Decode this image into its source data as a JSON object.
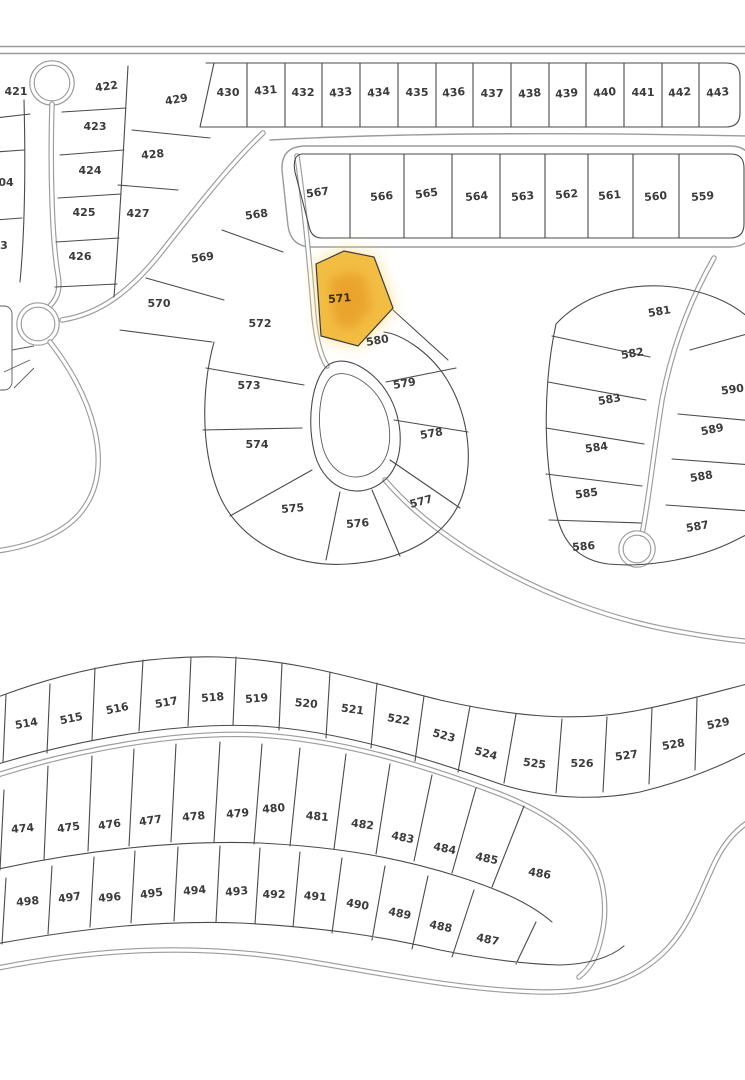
{
  "map": {
    "type": "subdivision-plat-map",
    "highlight": {
      "lot": "571",
      "fill": "#F2BD43",
      "glow": "#F8DC82",
      "core": "#E9A02C"
    },
    "colors": {
      "background": "#ffffff",
      "parcel_line": "#4a4a4a",
      "road_line": "#9b9b9b",
      "label": "#3b3b3b"
    },
    "lots": [
      {
        "n": "421",
        "x": 16,
        "y": 95,
        "r": 0
      },
      {
        "n": "422",
        "x": 107,
        "y": 90,
        "r": -8
      },
      {
        "n": "423",
        "x": 95,
        "y": 130,
        "r": 0
      },
      {
        "n": "424",
        "x": 90,
        "y": 174,
        "r": 0
      },
      {
        "n": "425",
        "x": 84,
        "y": 216,
        "r": 0
      },
      {
        "n": "426",
        "x": 80,
        "y": 260,
        "r": 0
      },
      {
        "n": "427",
        "x": 138,
        "y": 217,
        "r": 0
      },
      {
        "n": "428",
        "x": 153,
        "y": 158,
        "r": -5
      },
      {
        "n": "429",
        "x": 177,
        "y": 103,
        "r": -10
      },
      {
        "n": "04",
        "x": 6,
        "y": 186,
        "r": 0
      },
      {
        "n": "3",
        "x": 4,
        "y": 249,
        "r": 0
      },
      {
        "n": "430",
        "x": 228,
        "y": 96,
        "r": 0
      },
      {
        "n": "431",
        "x": 266,
        "y": 94,
        "r": -5
      },
      {
        "n": "432",
        "x": 303,
        "y": 96,
        "r": 0
      },
      {
        "n": "433",
        "x": 341,
        "y": 96,
        "r": -5
      },
      {
        "n": "434",
        "x": 379,
        "y": 96,
        "r": -5
      },
      {
        "n": "435",
        "x": 417,
        "y": 96,
        "r": 0
      },
      {
        "n": "436",
        "x": 454,
        "y": 96,
        "r": -5
      },
      {
        "n": "437",
        "x": 492,
        "y": 97,
        "r": 0
      },
      {
        "n": "438",
        "x": 530,
        "y": 97,
        "r": -5
      },
      {
        "n": "439",
        "x": 567,
        "y": 97,
        "r": -5
      },
      {
        "n": "440",
        "x": 605,
        "y": 96,
        "r": -5
      },
      {
        "n": "441",
        "x": 643,
        "y": 96,
        "r": 0
      },
      {
        "n": "442",
        "x": 680,
        "y": 96,
        "r": -5
      },
      {
        "n": "443",
        "x": 718,
        "y": 96,
        "r": -5
      },
      {
        "n": "567",
        "x": 318,
        "y": 196,
        "r": -8
      },
      {
        "n": "566",
        "x": 382,
        "y": 200,
        "r": -5
      },
      {
        "n": "565",
        "x": 427,
        "y": 197,
        "r": -8
      },
      {
        "n": "564",
        "x": 477,
        "y": 200,
        "r": -5
      },
      {
        "n": "563",
        "x": 523,
        "y": 200,
        "r": -5
      },
      {
        "n": "562",
        "x": 567,
        "y": 198,
        "r": -5
      },
      {
        "n": "561",
        "x": 610,
        "y": 199,
        "r": -5
      },
      {
        "n": "560",
        "x": 656,
        "y": 200,
        "r": -5
      },
      {
        "n": "559",
        "x": 703,
        "y": 200,
        "r": -5
      },
      {
        "n": "568",
        "x": 257,
        "y": 218,
        "r": -8
      },
      {
        "n": "569",
        "x": 203,
        "y": 261,
        "r": -8
      },
      {
        "n": "570",
        "x": 159,
        "y": 307,
        "r": 0
      },
      {
        "n": "571",
        "x": 340,
        "y": 302,
        "r": -5
      },
      {
        "n": "572",
        "x": 260,
        "y": 327,
        "r": 0
      },
      {
        "n": "573",
        "x": 249,
        "y": 389,
        "r": 0
      },
      {
        "n": "574",
        "x": 257,
        "y": 448,
        "r": 0
      },
      {
        "n": "575",
        "x": 293,
        "y": 512,
        "r": -5
      },
      {
        "n": "576",
        "x": 358,
        "y": 527,
        "r": -5
      },
      {
        "n": "577",
        "x": 422,
        "y": 505,
        "r": -15
      },
      {
        "n": "578",
        "x": 432,
        "y": 437,
        "r": -10
      },
      {
        "n": "579",
        "x": 405,
        "y": 387,
        "r": -10
      },
      {
        "n": "580",
        "x": 378,
        "y": 344,
        "r": -10
      },
      {
        "n": "581",
        "x": 660,
        "y": 315,
        "r": -10
      },
      {
        "n": "582",
        "x": 633,
        "y": 357,
        "r": -10
      },
      {
        "n": "583",
        "x": 610,
        "y": 403,
        "r": -10
      },
      {
        "n": "584",
        "x": 597,
        "y": 451,
        "r": -8
      },
      {
        "n": "585",
        "x": 587,
        "y": 497,
        "r": -8
      },
      {
        "n": "586",
        "x": 584,
        "y": 550,
        "r": -5
      },
      {
        "n": "587",
        "x": 698,
        "y": 530,
        "r": -10
      },
      {
        "n": "588",
        "x": 702,
        "y": 480,
        "r": -10
      },
      {
        "n": "589",
        "x": 713,
        "y": 433,
        "r": -12
      },
      {
        "n": "590",
        "x": 733,
        "y": 393,
        "r": -8
      },
      {
        "n": "514",
        "x": 27,
        "y": 727,
        "r": -10
      },
      {
        "n": "515",
        "x": 72,
        "y": 722,
        "r": -12
      },
      {
        "n": "516",
        "x": 118,
        "y": 712,
        "r": -12
      },
      {
        "n": "517",
        "x": 167,
        "y": 706,
        "r": -10
      },
      {
        "n": "518",
        "x": 213,
        "y": 701,
        "r": -5
      },
      {
        "n": "519",
        "x": 257,
        "y": 702,
        "r": -5
      },
      {
        "n": "520",
        "x": 306,
        "y": 707,
        "r": 5
      },
      {
        "n": "521",
        "x": 352,
        "y": 713,
        "r": 8
      },
      {
        "n": "522",
        "x": 398,
        "y": 723,
        "r": 10
      },
      {
        "n": "523",
        "x": 443,
        "y": 739,
        "r": 15
      },
      {
        "n": "524",
        "x": 485,
        "y": 757,
        "r": 15
      },
      {
        "n": "525",
        "x": 534,
        "y": 767,
        "r": 8
      },
      {
        "n": "526",
        "x": 582,
        "y": 767,
        "r": 0
      },
      {
        "n": "527",
        "x": 627,
        "y": 759,
        "r": -8
      },
      {
        "n": "528",
        "x": 674,
        "y": 748,
        "r": -10
      },
      {
        "n": "529",
        "x": 719,
        "y": 727,
        "r": -12
      },
      {
        "n": "474",
        "x": 23,
        "y": 832,
        "r": -5
      },
      {
        "n": "475",
        "x": 69,
        "y": 831,
        "r": -8
      },
      {
        "n": "476",
        "x": 110,
        "y": 828,
        "r": -8
      },
      {
        "n": "477",
        "x": 151,
        "y": 824,
        "r": -8
      },
      {
        "n": "478",
        "x": 194,
        "y": 820,
        "r": -5
      },
      {
        "n": "479",
        "x": 238,
        "y": 817,
        "r": -5
      },
      {
        "n": "480",
        "x": 274,
        "y": 812,
        "r": -5
      },
      {
        "n": "481",
        "x": 317,
        "y": 820,
        "r": 5
      },
      {
        "n": "482",
        "x": 362,
        "y": 828,
        "r": 8
      },
      {
        "n": "483",
        "x": 402,
        "y": 841,
        "r": 12
      },
      {
        "n": "484",
        "x": 444,
        "y": 852,
        "r": 12
      },
      {
        "n": "485",
        "x": 486,
        "y": 862,
        "r": 12
      },
      {
        "n": "486",
        "x": 539,
        "y": 877,
        "r": 10
      },
      {
        "n": "498",
        "x": 28,
        "y": 905,
        "r": -5
      },
      {
        "n": "497",
        "x": 70,
        "y": 901,
        "r": -8
      },
      {
        "n": "496",
        "x": 110,
        "y": 901,
        "r": -5
      },
      {
        "n": "495",
        "x": 152,
        "y": 897,
        "r": -8
      },
      {
        "n": "494",
        "x": 195,
        "y": 894,
        "r": -5
      },
      {
        "n": "493",
        "x": 237,
        "y": 895,
        "r": -5
      },
      {
        "n": "492",
        "x": 274,
        "y": 898,
        "r": 0
      },
      {
        "n": "491",
        "x": 315,
        "y": 900,
        "r": 5
      },
      {
        "n": "490",
        "x": 357,
        "y": 908,
        "r": 10
      },
      {
        "n": "489",
        "x": 399,
        "y": 917,
        "r": 12
      },
      {
        "n": "488",
        "x": 440,
        "y": 930,
        "r": 12
      },
      {
        "n": "487",
        "x": 487,
        "y": 943,
        "r": 12
      }
    ]
  }
}
